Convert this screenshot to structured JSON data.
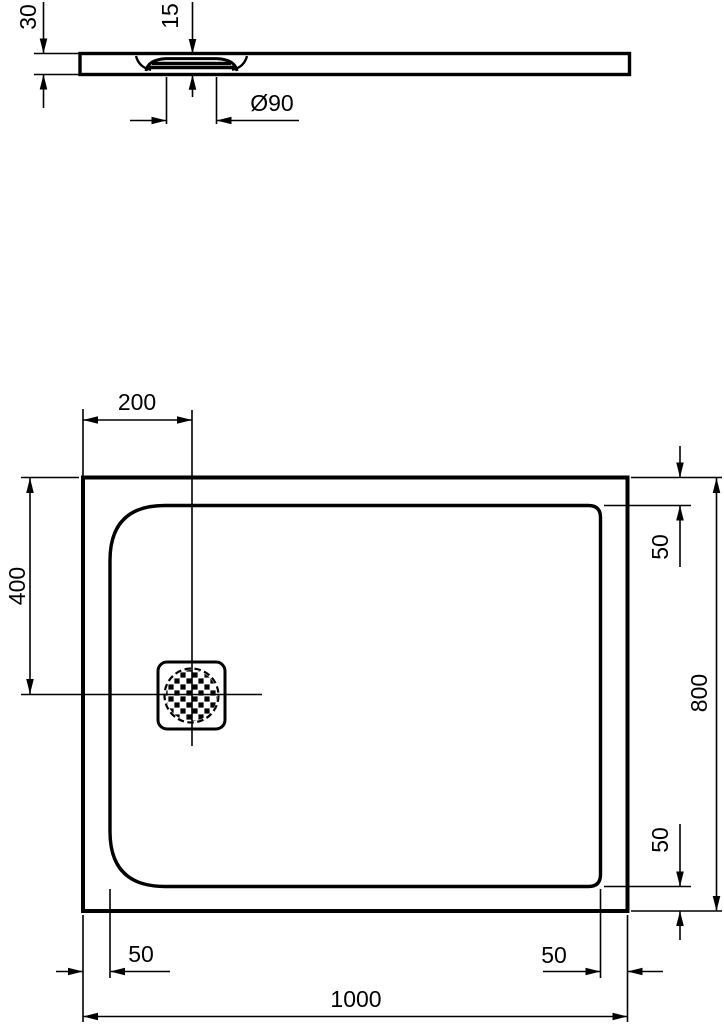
{
  "drawing": {
    "type": "technical-dimension-drawing",
    "subject": "rectangular shower tray with offset round drain",
    "colors": {
      "line": "#000000",
      "background": "#ffffff"
    },
    "side_view": {
      "overall_height_mm": "30",
      "drain_recess_depth_mm": "15",
      "drain_diameter_mm": "Ø90"
    },
    "plan_view": {
      "drain_center_from_left_mm": "200",
      "drain_center_from_top_mm": "400",
      "rim_inset_top_right_mm": "50",
      "overall_depth_mm": "800",
      "rim_inset_bottom_right_side_mm": "50",
      "rim_inset_bottom_left_mm": "50",
      "rim_inset_bottom_right_mm": "50",
      "overall_width_mm": "1000"
    }
  }
}
